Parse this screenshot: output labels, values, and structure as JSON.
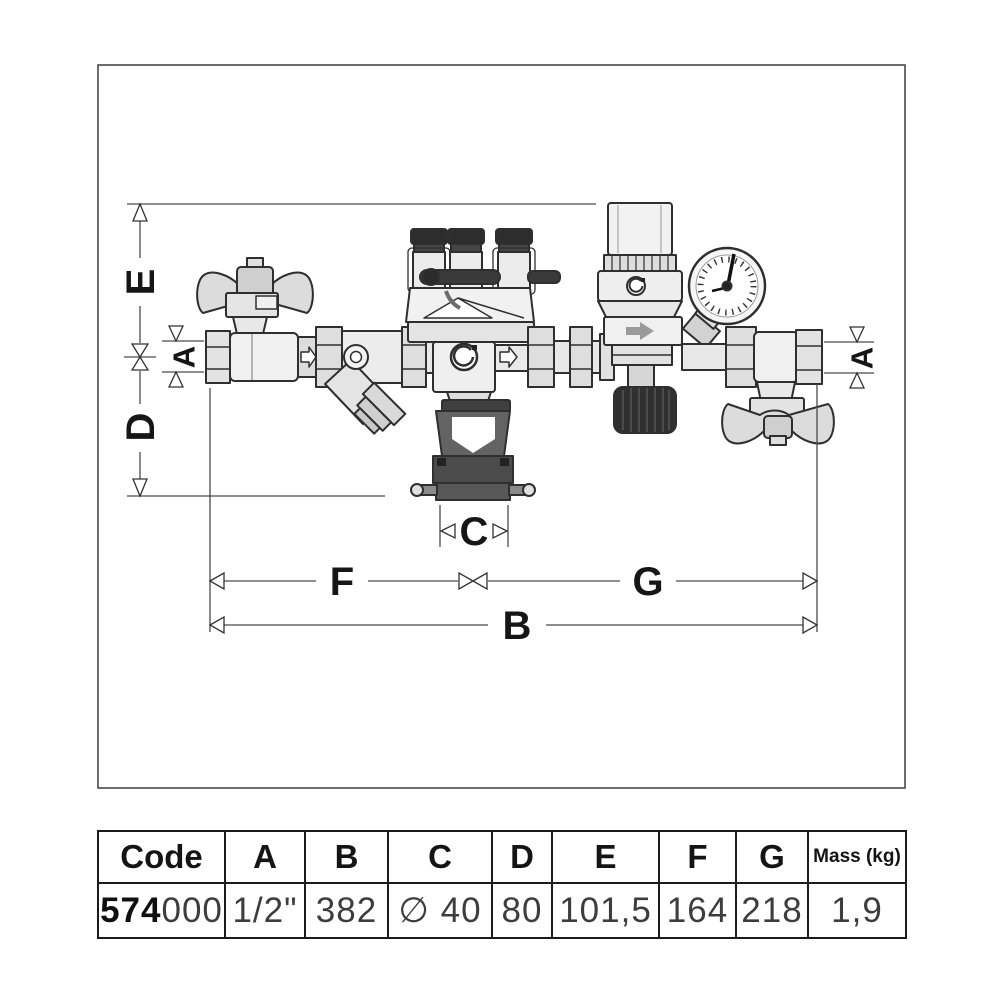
{
  "diagram": {
    "title": "valve-assembly-dimension-drawing",
    "dims": {
      "A": "A",
      "B": "B",
      "C": "C",
      "D": "D",
      "E": "E",
      "F": "F",
      "G": "G"
    },
    "components": [
      "left-ball-valve",
      "y-strainer",
      "backflow-preventer",
      "test-port-caps",
      "discharge-tundish",
      "pressure-reducing-valve",
      "pressure-gauge",
      "right-ball-valve"
    ],
    "colors": {
      "line": "#2f2f2f",
      "fill_light": "#efefef",
      "fill_dark": "#3a3a3a",
      "tundish": "#5e5e5e",
      "dim_line": "#4a4a4a"
    }
  },
  "table": {
    "headers": [
      "Code",
      "A",
      "B",
      "C",
      "D",
      "E",
      "F",
      "G",
      "Mass (kg)"
    ],
    "row": {
      "code_bold": "574",
      "code_rest": "000",
      "a": "1/2\"",
      "b": "382",
      "c": "∅ 40",
      "d": "80",
      "e": "101,5",
      "f": "164",
      "g": "218",
      "mass": "1,9"
    }
  }
}
